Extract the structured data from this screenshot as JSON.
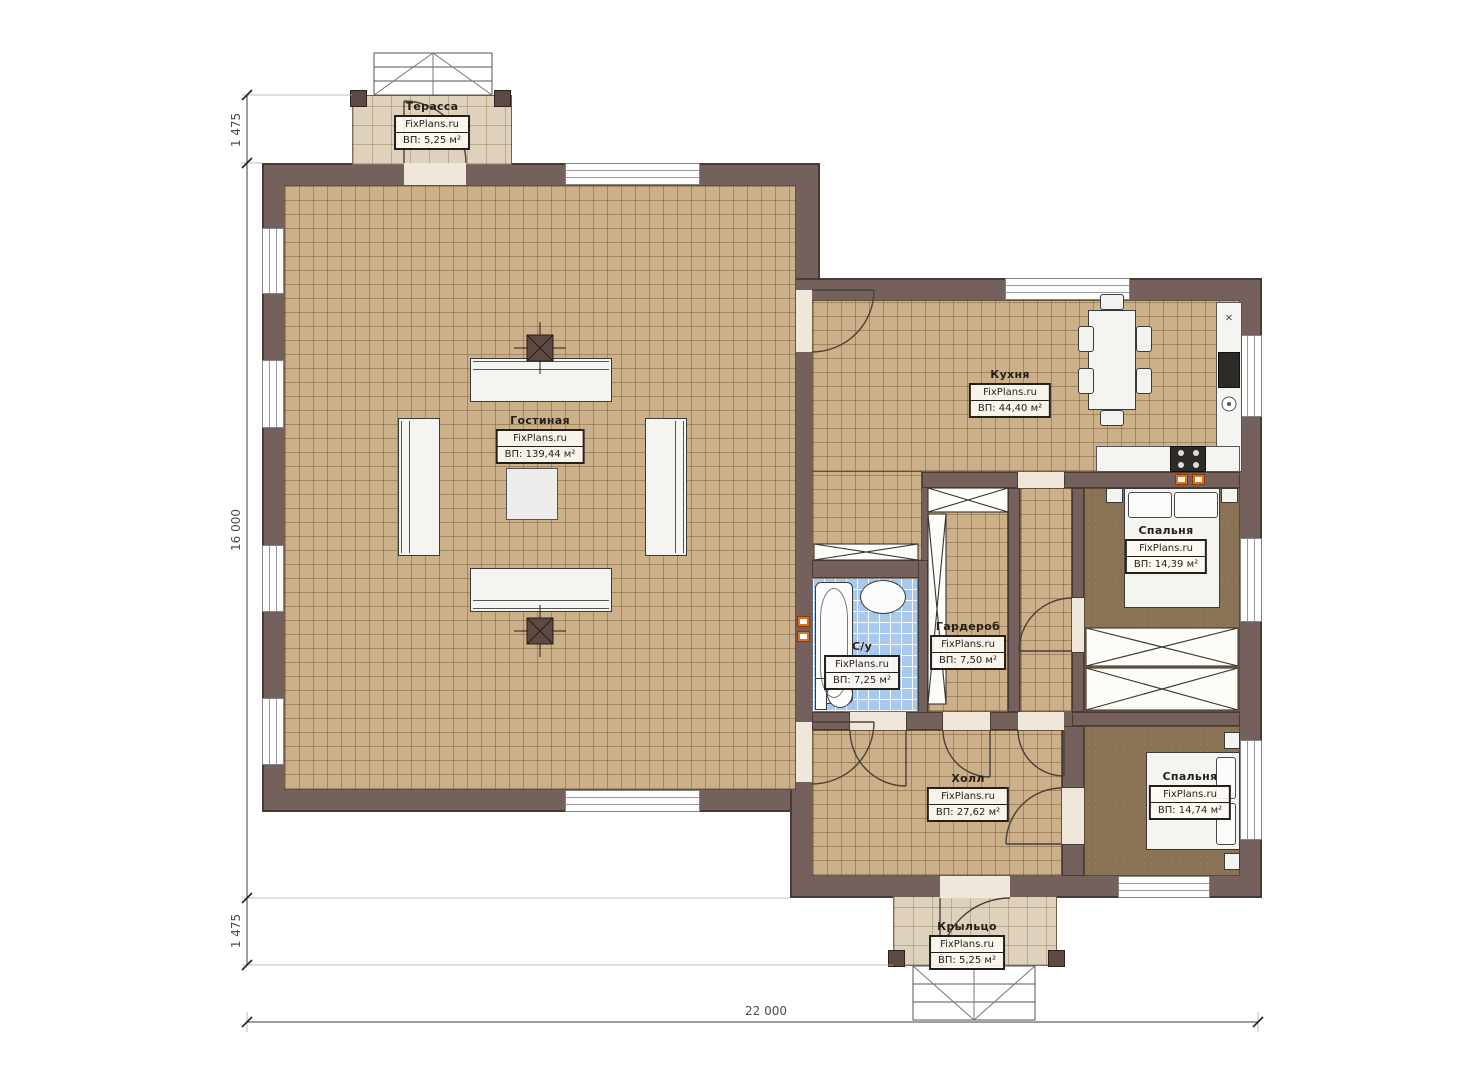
{
  "rooms": [
    {
      "name": "Терасса",
      "brand": "FixPlans.ru",
      "area": "ВП: 5,25 м²"
    },
    {
      "name": "Гостиная",
      "brand": "FixPlans.ru",
      "area": "ВП: 139,44 м²"
    },
    {
      "name": "Кухня",
      "brand": "FixPlans.ru",
      "area": "ВП: 44,40 м²"
    },
    {
      "name": "С/у",
      "brand": "FixPlans.ru",
      "area": "ВП: 7,25 м²"
    },
    {
      "name": "Гардероб",
      "brand": "FixPlans.ru",
      "area": "ВП: 7,50 м²"
    },
    {
      "name": "Спальня",
      "brand": "FixPlans.ru",
      "area": "ВП: 14,39 м²"
    },
    {
      "name": "Холл",
      "brand": "FixPlans.ru",
      "area": "ВП: 27,62 м²"
    },
    {
      "name": "Спальня",
      "brand": "FixPlans.ru",
      "area": "ВП: 14,74 м²"
    },
    {
      "name": "Крыльцо",
      "brand": "FixPlans.ru",
      "area": "ВП: 5,25 м²"
    }
  ],
  "dimensions": {
    "left_top": "1 475",
    "left_main": "16 000",
    "left_bottom": "1 475",
    "bottom": "22 000"
  },
  "symbols": {
    "counter_box": "×"
  },
  "colors": {
    "wall": "#74605c",
    "floor_tile": "#cbb08a",
    "floor_deck": "#ded2bc",
    "bath_tile": "#a9c9ec",
    "carpet": "#8a7254",
    "marker_orange": "#e0701f"
  }
}
